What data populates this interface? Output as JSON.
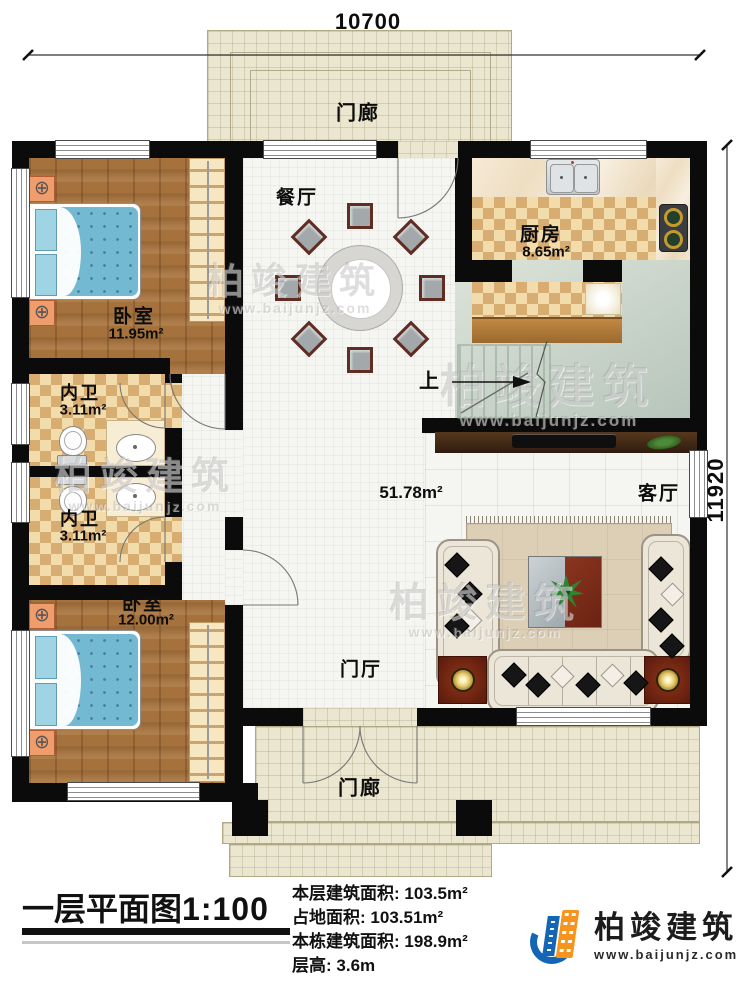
{
  "plan": {
    "dims": {
      "top": "10700",
      "right": "11920"
    },
    "rooms": {
      "porch_top": {
        "label": "门廊"
      },
      "dining": {
        "label": "餐厅"
      },
      "kitchen": {
        "label": "厨房",
        "area": "8.65m²"
      },
      "bedroom1": {
        "label": "卧室",
        "area": "11.95m²"
      },
      "bath1": {
        "label": "内卫",
        "area": "3.11m²"
      },
      "bath2": {
        "label": "内卫",
        "area": "3.11m²"
      },
      "bedroom2": {
        "label": "卧室",
        "area": "12.00m²"
      },
      "living": {
        "label": "客厅"
      },
      "foyer": {
        "label": "门厅"
      },
      "porch_bottom": {
        "label": "门廊"
      },
      "stairs": {
        "label": "上"
      },
      "open_area": {
        "area": "51.78m²"
      }
    }
  },
  "footer": {
    "title": "一层平面图",
    "scale": "1:100",
    "stats": [
      {
        "label": "本层建筑面积:",
        "value": "103.5m²"
      },
      {
        "label": "占地面积:",
        "value": "103.51m²"
      },
      {
        "label": "本栋建筑面积:",
        "value": "198.9m²"
      },
      {
        "label": "层高:",
        "value": "3.6m"
      }
    ],
    "logo": {
      "name": "柏竣建筑",
      "site": "www.baijunjz.com"
    }
  },
  "watermark": {
    "brand": "柏竣建筑",
    "site": "www.baijunjz.com"
  },
  "colors": {
    "wall": "#0b0b0b",
    "wood_floor": "#a5713c",
    "checker_dark": "#d7ad72",
    "porch": "#eae6cf",
    "logo_blue": "#1465b3",
    "logo_orange": "#f7941d"
  }
}
